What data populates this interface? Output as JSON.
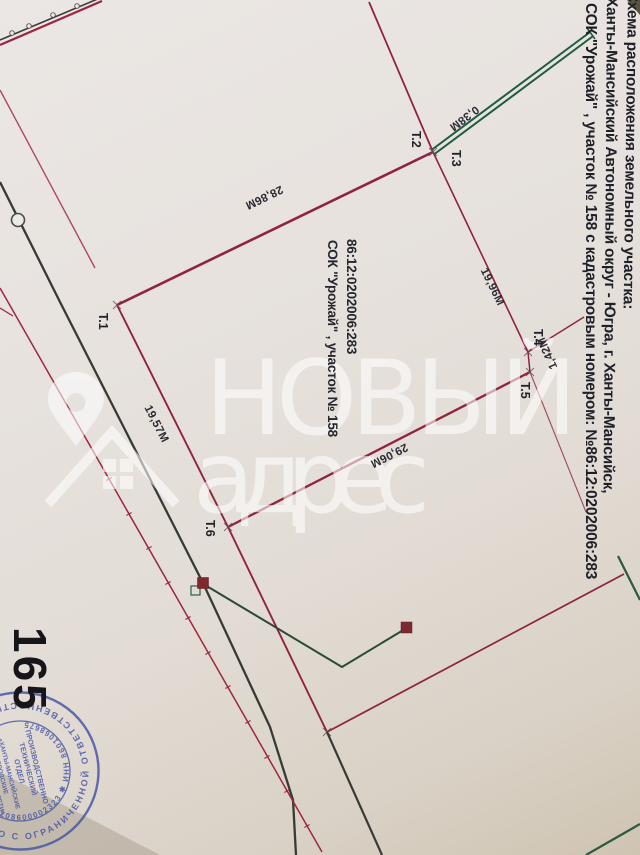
{
  "document": {
    "page_number": "165",
    "title_lines": {
      "line1": "Схема расположения земельного участка:",
      "line2": "Ханты-Мансийский Автономный округ - Югра, г. Ханты-Мансийск,",
      "line3": "СОК \"Урожай\" , участок № 158 с кадастровым номером: №86:12:0202006:283"
    },
    "parcel": {
      "cadastral_number": "86:12:0202006:283",
      "name_line": "СОК \"Урожай\" , участок № 158"
    },
    "points": {
      "t1": "Т.1",
      "t2": "Т.2",
      "t3": "Т.3",
      "t4": "Т.4",
      "t5": "Т.5",
      "t6": "Т.6"
    },
    "measurements": {
      "d_t2_t3": "0,38М",
      "d_t1_t2": "28,86М",
      "d_t3_t4": "19,96М",
      "d_t4_t5": "1,42М",
      "d_t5_t6": "29,06М",
      "d_t6_t1": "19,57М"
    }
  },
  "watermark": {
    "brand_top": "НОВЫЙ",
    "brand_bottom": "адрес"
  },
  "stamp": {
    "outer_ring": "ОБЩЕСТВО С ОГРАНИЧЕННОЙ ОТВЕТСТВЕННОСТЬЮ ✱",
    "inner_ring": "ОГРН 1208600002323  ✱  ИНН 8601068675",
    "center_line1": "ПРОИЗВОДСТВЕННО",
    "center_line2": "ТЕХНИЧЕСКИЙ",
    "center_line3": "ОТДЕЛ",
    "center_line4": "«ХАНТЫ-МАНСИЙСКИЕ",
    "center_line5": "ГОРОДСКИЕ",
    "center_line6": "ЭЛЕКТРИЧЕСКИЕ СЕТИ»"
  },
  "colors": {
    "boundary_red": "#8f2340",
    "aux_red": "#9b2742",
    "road_black": "#383b35",
    "green_line": "#1f5c3c",
    "stamp_blue": "#4353a5",
    "marker_maroon": "#7c2a2e",
    "ink": "#23232b"
  }
}
